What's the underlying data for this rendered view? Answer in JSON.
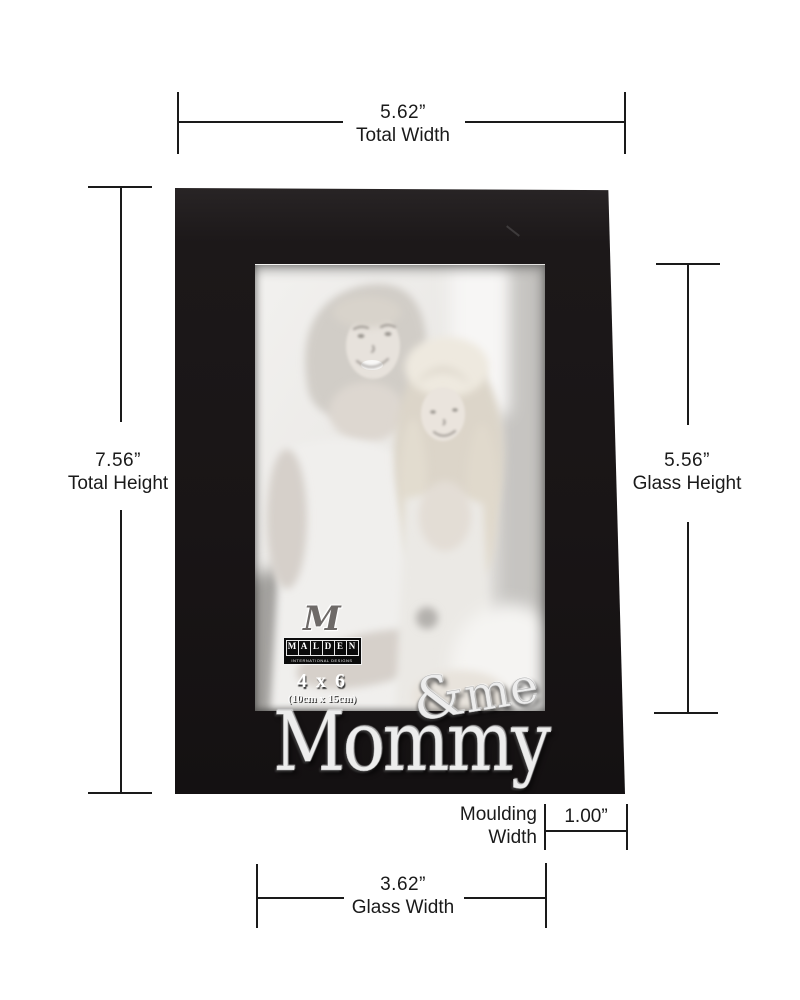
{
  "page": {
    "background": "#ffffff"
  },
  "dimensions": {
    "total_width": {
      "value": "5.62”",
      "label": "Total Width"
    },
    "total_height": {
      "value": "7.56”",
      "label": "Total Height"
    },
    "glass_height": {
      "value": "5.56”",
      "label": "Glass Height"
    },
    "glass_width": {
      "value": "3.62”",
      "label": "Glass Width"
    },
    "moulding_width": {
      "value": "1.00”",
      "label": "Moulding Width"
    }
  },
  "frame": {
    "brand": {
      "monogram": "M",
      "letters": [
        "M",
        "A",
        "L",
        "D",
        "E",
        "N"
      ],
      "subtitle": "INTERNATIONAL DESIGNS"
    },
    "size": {
      "label": "4 x 6",
      "metric": "(10cm x 15cm)"
    },
    "caption": {
      "amp": "&",
      "me": "me",
      "word": "Mommy"
    },
    "colors": {
      "frame": "#1c1819",
      "silver": "#ededed",
      "line": "#1a1a1a"
    }
  }
}
